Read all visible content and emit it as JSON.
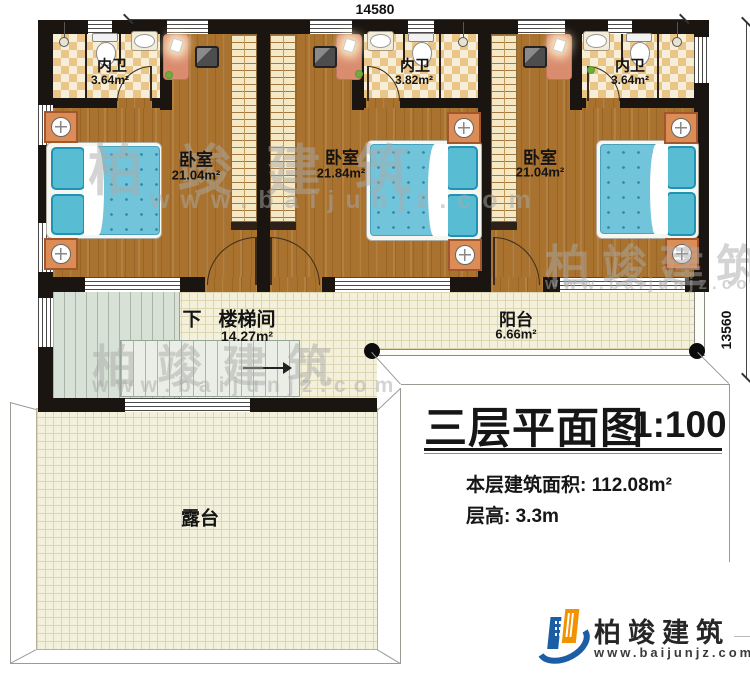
{
  "dimensions": {
    "top_width": "14580",
    "right_height": "13560"
  },
  "rooms": {
    "bath1": {
      "label": "内卫",
      "area": "3.64m²"
    },
    "bath2": {
      "label": "内卫",
      "area": "3.82m²"
    },
    "bath3": {
      "label": "内卫",
      "area": "3.64m²"
    },
    "bedroom1": {
      "label": "卧室",
      "area": "21.04m²"
    },
    "bedroom2": {
      "label": "卧室",
      "area": "21.84m²"
    },
    "bedroom3": {
      "label": "卧室",
      "area": "21.04m²"
    },
    "stairwell": {
      "direction": "下",
      "label": "楼梯间",
      "area": "14.27m²"
    },
    "balcony": {
      "label": "阳台",
      "area": "6.66m²"
    },
    "terrace": {
      "label": "露台"
    }
  },
  "title_block": {
    "title": "三层平面图",
    "scale": "1:100",
    "floor_area": "本层建筑面积: 112.08m²",
    "floor_height": "层高: 3.3m"
  },
  "logo": {
    "company": "柏竣建筑",
    "website": "www.baijunjz.com"
  },
  "watermark": {
    "text": "柏竣建筑",
    "website": "www.baijunjz.com"
  },
  "colors": {
    "wall": "#1a1510",
    "wood": "#a9722e",
    "tile_a": "#e9c588",
    "tile_b": "#f7eeda",
    "floor_bg": "#f3f0db",
    "stair_green": "#d8e1d5",
    "wardrobe": "#f5e8c5",
    "bed_blue": "#72c4db",
    "pillow": "#58bdd3",
    "nightstand": "#dc8c55",
    "rug": "#d98c6e",
    "logo_blue": "#1b5ea6",
    "logo_orange": "#f29200"
  }
}
